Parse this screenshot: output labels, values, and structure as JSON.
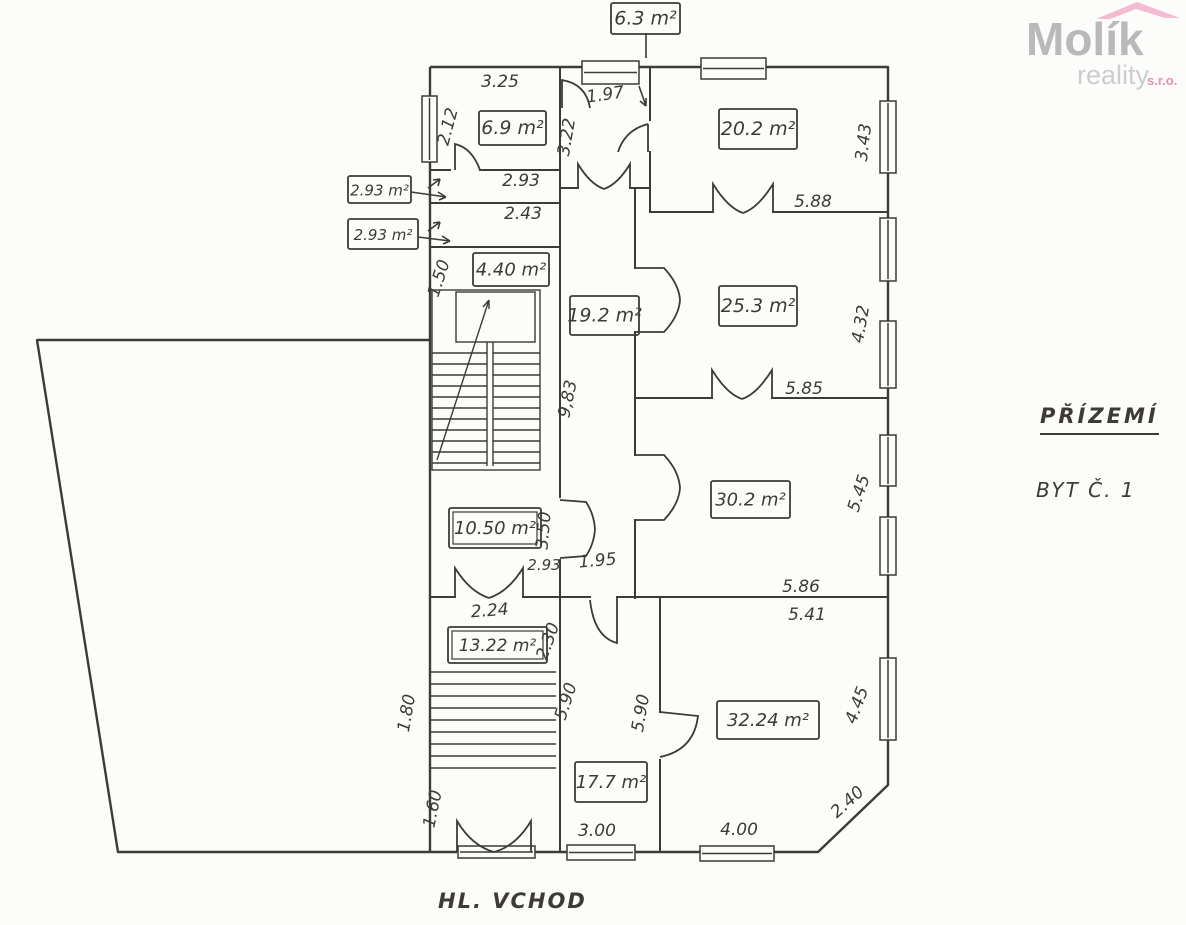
{
  "logo": {
    "brand": "Molík",
    "tagline": "reality",
    "suffix": "s.r.o.",
    "brand_color": "#b9b9b9",
    "tagline_color": "#cdcdcd",
    "suffix_color": "#ee8cb6",
    "roof_color": "#f3bad2"
  },
  "titles": {
    "floor": "PŘÍZEMÍ",
    "unit": "BYT Č. 1",
    "entrance": "HL. VCHOD"
  },
  "colors": {
    "paper": "#fcfcfb",
    "ink": "#3d3a38"
  },
  "room_labels": [
    {
      "text": "6.3 m²",
      "x": 611,
      "y": 3,
      "w": 69,
      "h": 31,
      "size": 19
    },
    {
      "text": "6.9 m²",
      "x": 479,
      "y": 111,
      "w": 67,
      "h": 34,
      "size": 19
    },
    {
      "text": "2.93 m²",
      "x": 348,
      "y": 176,
      "w": 63,
      "h": 27,
      "size": 15
    },
    {
      "text": "2.93 m²",
      "x": 348,
      "y": 219,
      "w": 70,
      "h": 30,
      "size": 15
    },
    {
      "text": "4.40 m²",
      "x": 473,
      "y": 253,
      "w": 76,
      "h": 33,
      "size": 18
    },
    {
      "text": "19.2 m²",
      "x": 570,
      "y": 296,
      "w": 69,
      "h": 39,
      "size": 19
    },
    {
      "text": "20.2 m²",
      "x": 719,
      "y": 109,
      "w": 78,
      "h": 40,
      "size": 19
    },
    {
      "text": "25.3 m²",
      "x": 719,
      "y": 286,
      "w": 78,
      "h": 40,
      "size": 19
    },
    {
      "text": "30.2 m²",
      "x": 711,
      "y": 481,
      "w": 79,
      "h": 37,
      "size": 18
    },
    {
      "text": "10.50 m²",
      "x": 449,
      "y": 508,
      "w": 92,
      "h": 40,
      "size": 18,
      "double": true
    },
    {
      "text": "13.22 m²",
      "x": 448,
      "y": 627,
      "w": 99,
      "h": 36,
      "size": 17,
      "double": true
    },
    {
      "text": "32.24 m²",
      "x": 717,
      "y": 701,
      "w": 102,
      "h": 38,
      "size": 18
    },
    {
      "text": "17.7 m²",
      "x": 575,
      "y": 762,
      "w": 72,
      "h": 40,
      "size": 18
    }
  ],
  "dimensions": [
    {
      "text": "3.25",
      "x": 500,
      "y": 87
    },
    {
      "text": "2.12",
      "x": 453,
      "y": 128,
      "rot": -75
    },
    {
      "text": "1.97",
      "x": 606,
      "y": 100,
      "rot": -8
    },
    {
      "text": "3.22",
      "x": 572,
      "y": 138,
      "rot": -80
    },
    {
      "text": "2.93",
      "x": 521,
      "y": 186
    },
    {
      "text": "2.43",
      "x": 523,
      "y": 219
    },
    {
      "text": "3.43",
      "x": 869,
      "y": 143,
      "rot": -83
    },
    {
      "text": "5.88",
      "x": 813,
      "y": 207
    },
    {
      "text": "1.50",
      "x": 444,
      "y": 280,
      "rot": -72
    },
    {
      "text": "4.32",
      "x": 866,
      "y": 325,
      "rot": -80
    },
    {
      "text": "5.85",
      "x": 804,
      "y": 394
    },
    {
      "text": "9,83",
      "x": 573,
      "y": 400,
      "rot": -78
    },
    {
      "text": "5.45",
      "x": 864,
      "y": 495,
      "rot": -72
    },
    {
      "text": "3.50",
      "x": 549,
      "y": 531,
      "rot": -85
    },
    {
      "text": "2.93",
      "x": 544,
      "y": 570,
      "size": 15
    },
    {
      "text": "1.95",
      "x": 598,
      "y": 566,
      "rot": -5
    },
    {
      "text": "5.86",
      "x": 801,
      "y": 592
    },
    {
      "text": "5.41",
      "x": 807,
      "y": 620
    },
    {
      "text": "2.24",
      "x": 490,
      "y": 616,
      "rot": -4
    },
    {
      "text": "2.30",
      "x": 553,
      "y": 643,
      "rot": -70
    },
    {
      "text": "1.80",
      "x": 412,
      "y": 714,
      "rot": -80
    },
    {
      "text": "5.90",
      "x": 571,
      "y": 703,
      "rot": -72
    },
    {
      "text": "5.90",
      "x": 646,
      "y": 714,
      "rot": -80
    },
    {
      "text": "4.45",
      "x": 862,
      "y": 707,
      "rot": -70
    },
    {
      "text": "1.60",
      "x": 438,
      "y": 810,
      "rot": -78
    },
    {
      "text": "3.00",
      "x": 597,
      "y": 836
    },
    {
      "text": "4.00",
      "x": 739,
      "y": 835
    },
    {
      "text": "2.40",
      "x": 851,
      "y": 806,
      "rot": -42
    }
  ]
}
